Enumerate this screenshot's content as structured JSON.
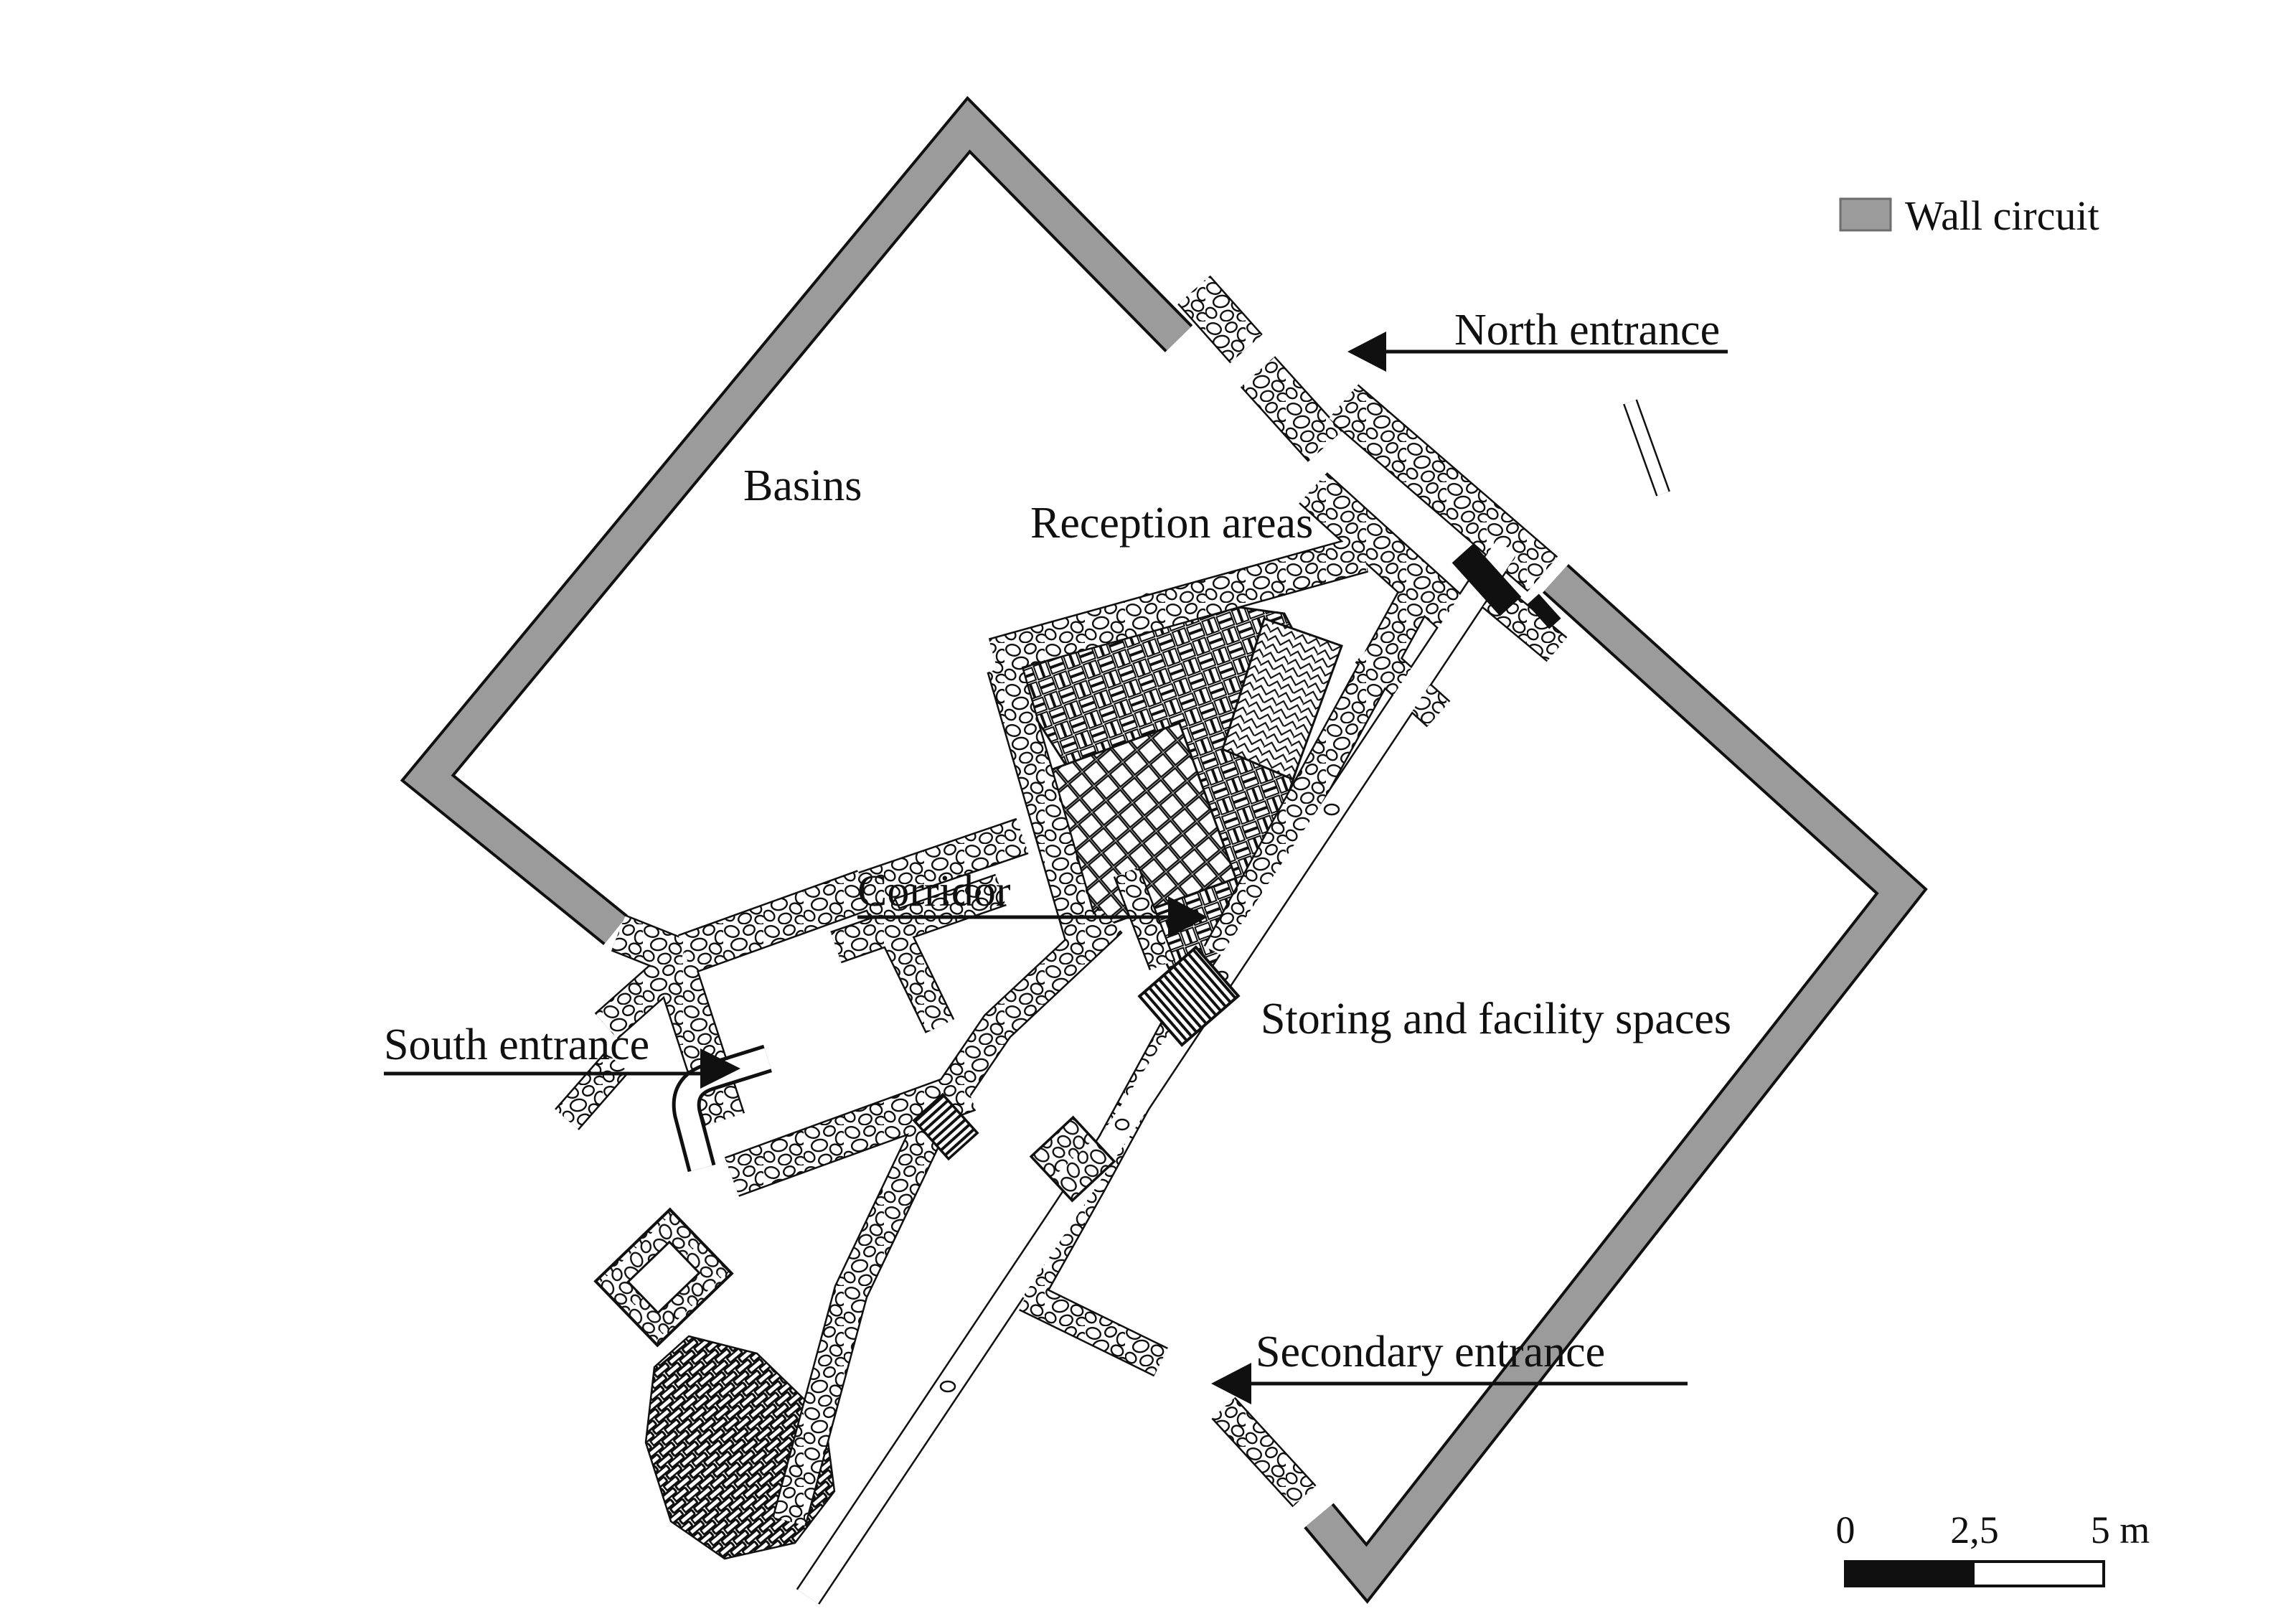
{
  "figure": {
    "type": "archaeological-site-plan",
    "description": "Plan of excavated building remains inside a rotated quadrangular wall circuit"
  },
  "labels": {
    "basins": "Basins",
    "reception": "Reception areas",
    "north_entrance": "North entrance",
    "corridor": "Corridor",
    "south_entrance": "South entrance",
    "storing": "Storing and facility spaces",
    "secondary_entrance": "Secondary entrance"
  },
  "legend": {
    "wall_circuit_label": "Wall circuit"
  },
  "scale_bar": {
    "zero": "0",
    "mid": "2,5",
    "end": "5 m"
  },
  "colors": {
    "wall_circuit": "#9b9b9b",
    "wall_circuit_edge": "#6e6e6e",
    "ink": "#101010",
    "paper": "#ffffff"
  }
}
